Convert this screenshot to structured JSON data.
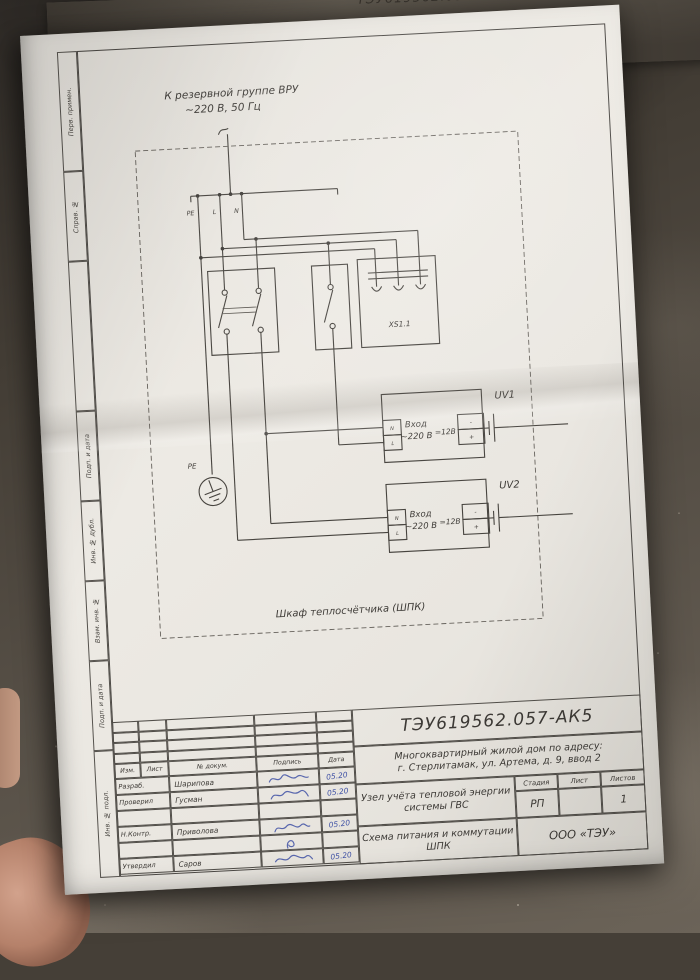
{
  "colors": {
    "paper": "#e9e6e0",
    "ink_blue": "#3f51a5",
    "line": "#47443f",
    "floor": "#575047"
  },
  "background_sheet": {
    "code": "ТЭУ619562.057-АК1",
    "subtitle": "Многоквартирный жилой дом по адресу:"
  },
  "side_labels": [
    "Перв. примен.",
    "Справ. №",
    "",
    "Подп. и дата",
    "Инв. № дубл.",
    "Взам. инв. №",
    "Подп. и дата",
    "Инв. № подл."
  ],
  "schematic": {
    "feeder_label_line1": "К резервной группе ВРУ",
    "feeder_label_line2": "~220 В, 50 Гц",
    "terminals": {
      "pe": "PE",
      "l": "L",
      "n": "N"
    },
    "ground_label": "PE",
    "socket_label": "XS1.1",
    "cabinet_label": "Шкаф теплосчётчика (ШПК)",
    "psu1": {
      "name": "UV1",
      "in_n": "N",
      "in_l": "L",
      "input_line1": "Вход",
      "input_line2": "~220 В",
      "output": "=12В",
      "minus": "-",
      "plus": "+"
    },
    "psu2": {
      "name": "UV2",
      "in_n": "N",
      "in_l": "L",
      "input_line1": "Вход",
      "input_line2": "~220 В",
      "output": "=12В",
      "minus": "-",
      "plus": "+"
    }
  },
  "title_block": {
    "doc_code": "ТЭУ619562.057-АК5",
    "object_line1": "Многоквартирный жилой дом по адресу:",
    "object_line2": "г. Стерлитамак, ул. Артема, д. 9, ввод 2",
    "doc_name_line1": "Узел учёта тепловой энергии",
    "doc_name_line2": "системы ГВС",
    "sheet_name_line1": "Схема питания и коммутации",
    "sheet_name_line2": "ШПК",
    "stage_label": "Стадия",
    "stage_value": "РП",
    "sheet_label": "Лист",
    "sheet_value": "",
    "sheets_label": "Листов",
    "sheets_value": "1",
    "company": "ООО «ТЭУ»",
    "sig_table": {
      "headers": [
        "Изм.",
        "Лист",
        "№ докум.",
        "Подпись",
        "Дата"
      ],
      "rows": [
        {
          "role": "Разраб.",
          "name": "Шарипова",
          "date": "05.20"
        },
        {
          "role": "Проверил",
          "name": "Гусман",
          "date": "05.20"
        },
        {
          "role": "",
          "name": "",
          "date": ""
        },
        {
          "role": "Н.Контр.",
          "name": "Приволова",
          "date": "05.20"
        },
        {
          "role": "",
          "name": "",
          "date": ""
        },
        {
          "role": "Утвердил",
          "name": "Саров",
          "date": "05.20"
        }
      ]
    }
  }
}
